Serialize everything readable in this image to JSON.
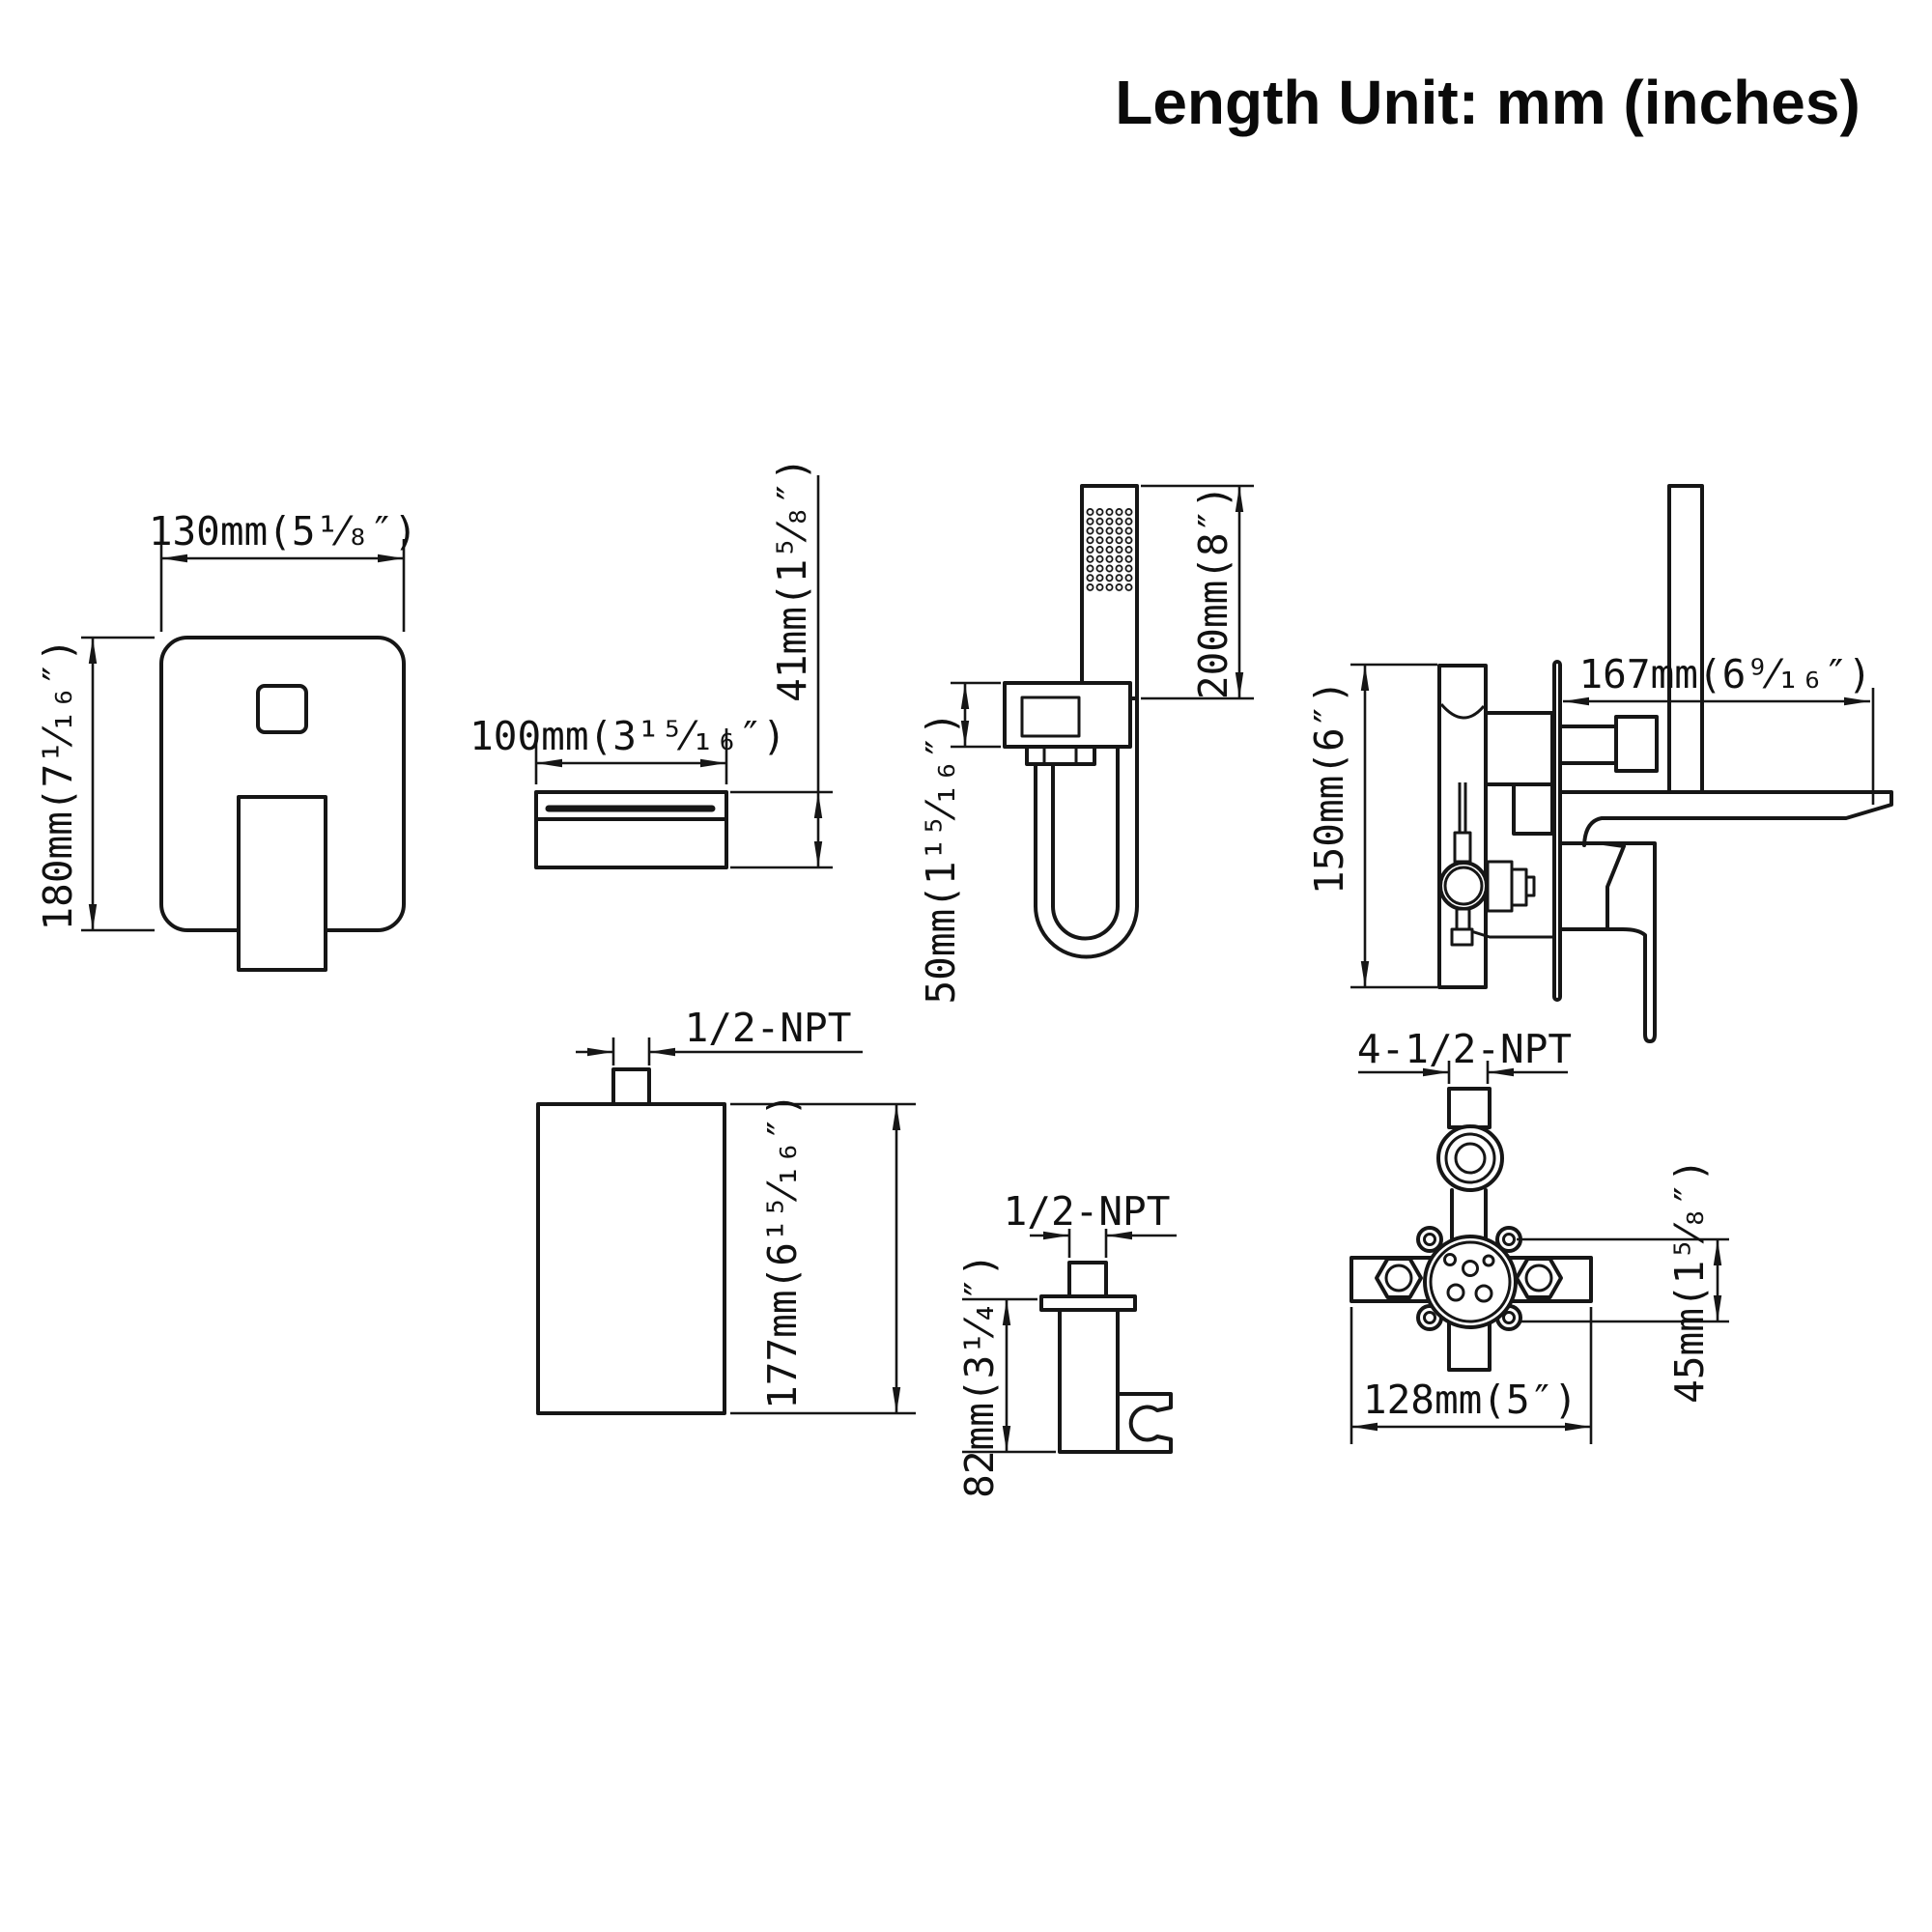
{
  "title": "Length Unit: mm (inches)",
  "colors": {
    "line": "#161616",
    "background": "#ffffff"
  },
  "views": {
    "trim_plate_front": {
      "width": "130mm(5¹⁄₈″)",
      "height": "180mm(7¹⁄₁₆″)"
    },
    "spout_front": {
      "width": "100mm(3¹⁵⁄₁₆″)",
      "height": "41mm(1⁵⁄₈″)"
    },
    "hand_shower": {
      "wand_length": "200mm(8″)",
      "outlet_offset": "50mm(1¹⁵⁄₁₆″)"
    },
    "faucet_side": {
      "spout_reach": "167mm(6⁹⁄₁₆″)",
      "trim_height": "150mm(6″)"
    },
    "valve_box": {
      "connection": "1/2-NPT",
      "height": "177mm(6¹⁵⁄₁₆″)"
    },
    "shower_holder": {
      "connection": "1/2-NPT",
      "height": "82mm(3¹⁄₄″)"
    },
    "rough_in_valve": {
      "connections": "4-1/2-NPT",
      "width": "128mm(5″)",
      "depth": "45mm(1⁵⁄₈″)"
    }
  }
}
